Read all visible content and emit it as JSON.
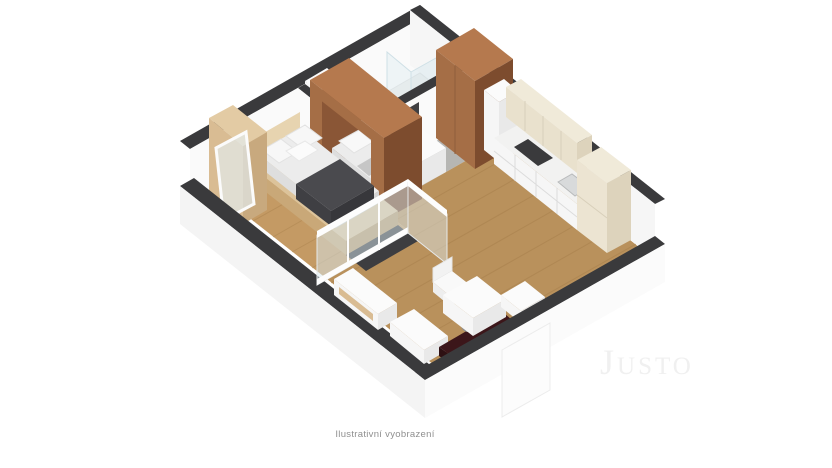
{
  "caption": "Ilustrativní vyobrazení",
  "watermark": "Justo",
  "colors": {
    "wall_top": "#3a3a3c",
    "wall_face": "#fafafa",
    "ext_face_sw": "#f4f4f4",
    "ext_face_se": "#fbfbfb",
    "floor_wood": "#b9915c",
    "floor_wood_line": "#a57d49",
    "floor_bedroom": "#c49a64",
    "floor_hall": "#b6b6b3",
    "floor_bath": "#d7d7d4",
    "wood_light": "#dcc39a",
    "wood_mid": "#c9a878",
    "wood_dark": "#b8986a",
    "wardrobe_face": "#d9bc93",
    "wardrobe_side": "#c8a97e",
    "wardrobe_top": "#e3cba4",
    "headboard": "#e7d4b0",
    "brown_top": "#b5794e",
    "brown_light": "#a56e46",
    "brown_dark": "#7d4c2e",
    "brown_inner": "#8a5636",
    "cream_top": "#f0ead9",
    "cream_face": "#e9e1cd",
    "cream_side": "#ddd3bc",
    "mattress_top": "#ececec",
    "mattress_side": "#dedede",
    "mattress_edge": "#d4d4d4",
    "blanket_dark": "#4a4a4e",
    "shadow_dark": "#3d3d40",
    "maroon": "#3c161a",
    "maroon_end": "#2e1013",
    "glass_fill": "rgba(215,232,238,0.5)",
    "cooktop": "#3a3a3c",
    "steel": "#d8dadb"
  }
}
